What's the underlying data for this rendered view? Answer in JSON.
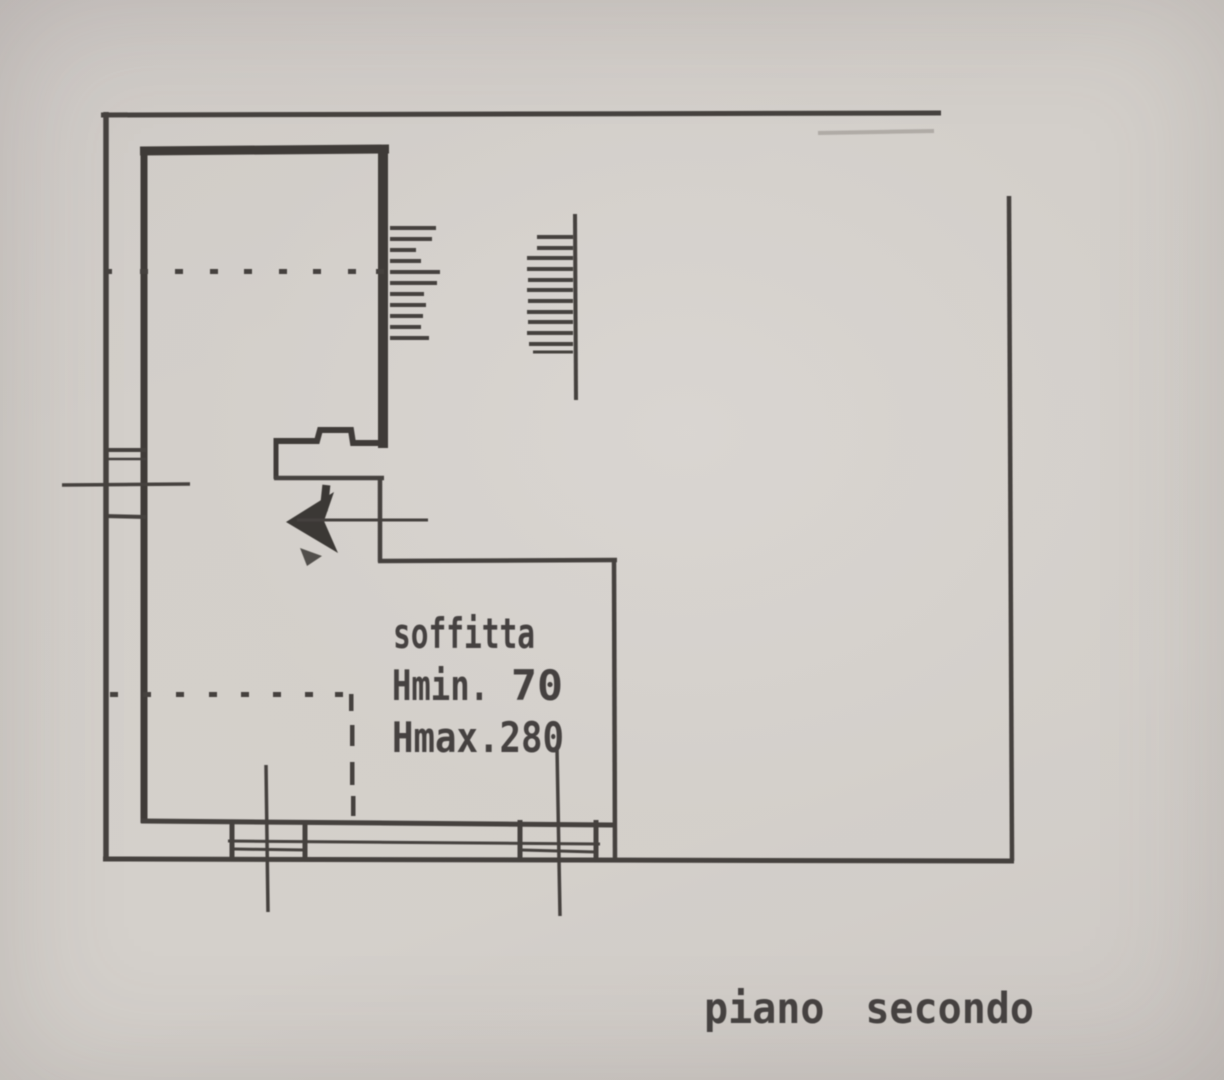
{
  "document": {
    "labels": {
      "room_name": "soffitta",
      "height_min_label": "Hmin.",
      "height_min_value": "70",
      "height_max": "Hmax.280",
      "floor_title": "piano secondo"
    }
  },
  "colors": {
    "paper": "#d3cfca",
    "ink": "#45413e",
    "wall_ink": "#3f3b38",
    "text_ink": "#454140"
  },
  "icons": {
    "stair_direction_arrow": "left-pointing filled dart with tail line"
  }
}
